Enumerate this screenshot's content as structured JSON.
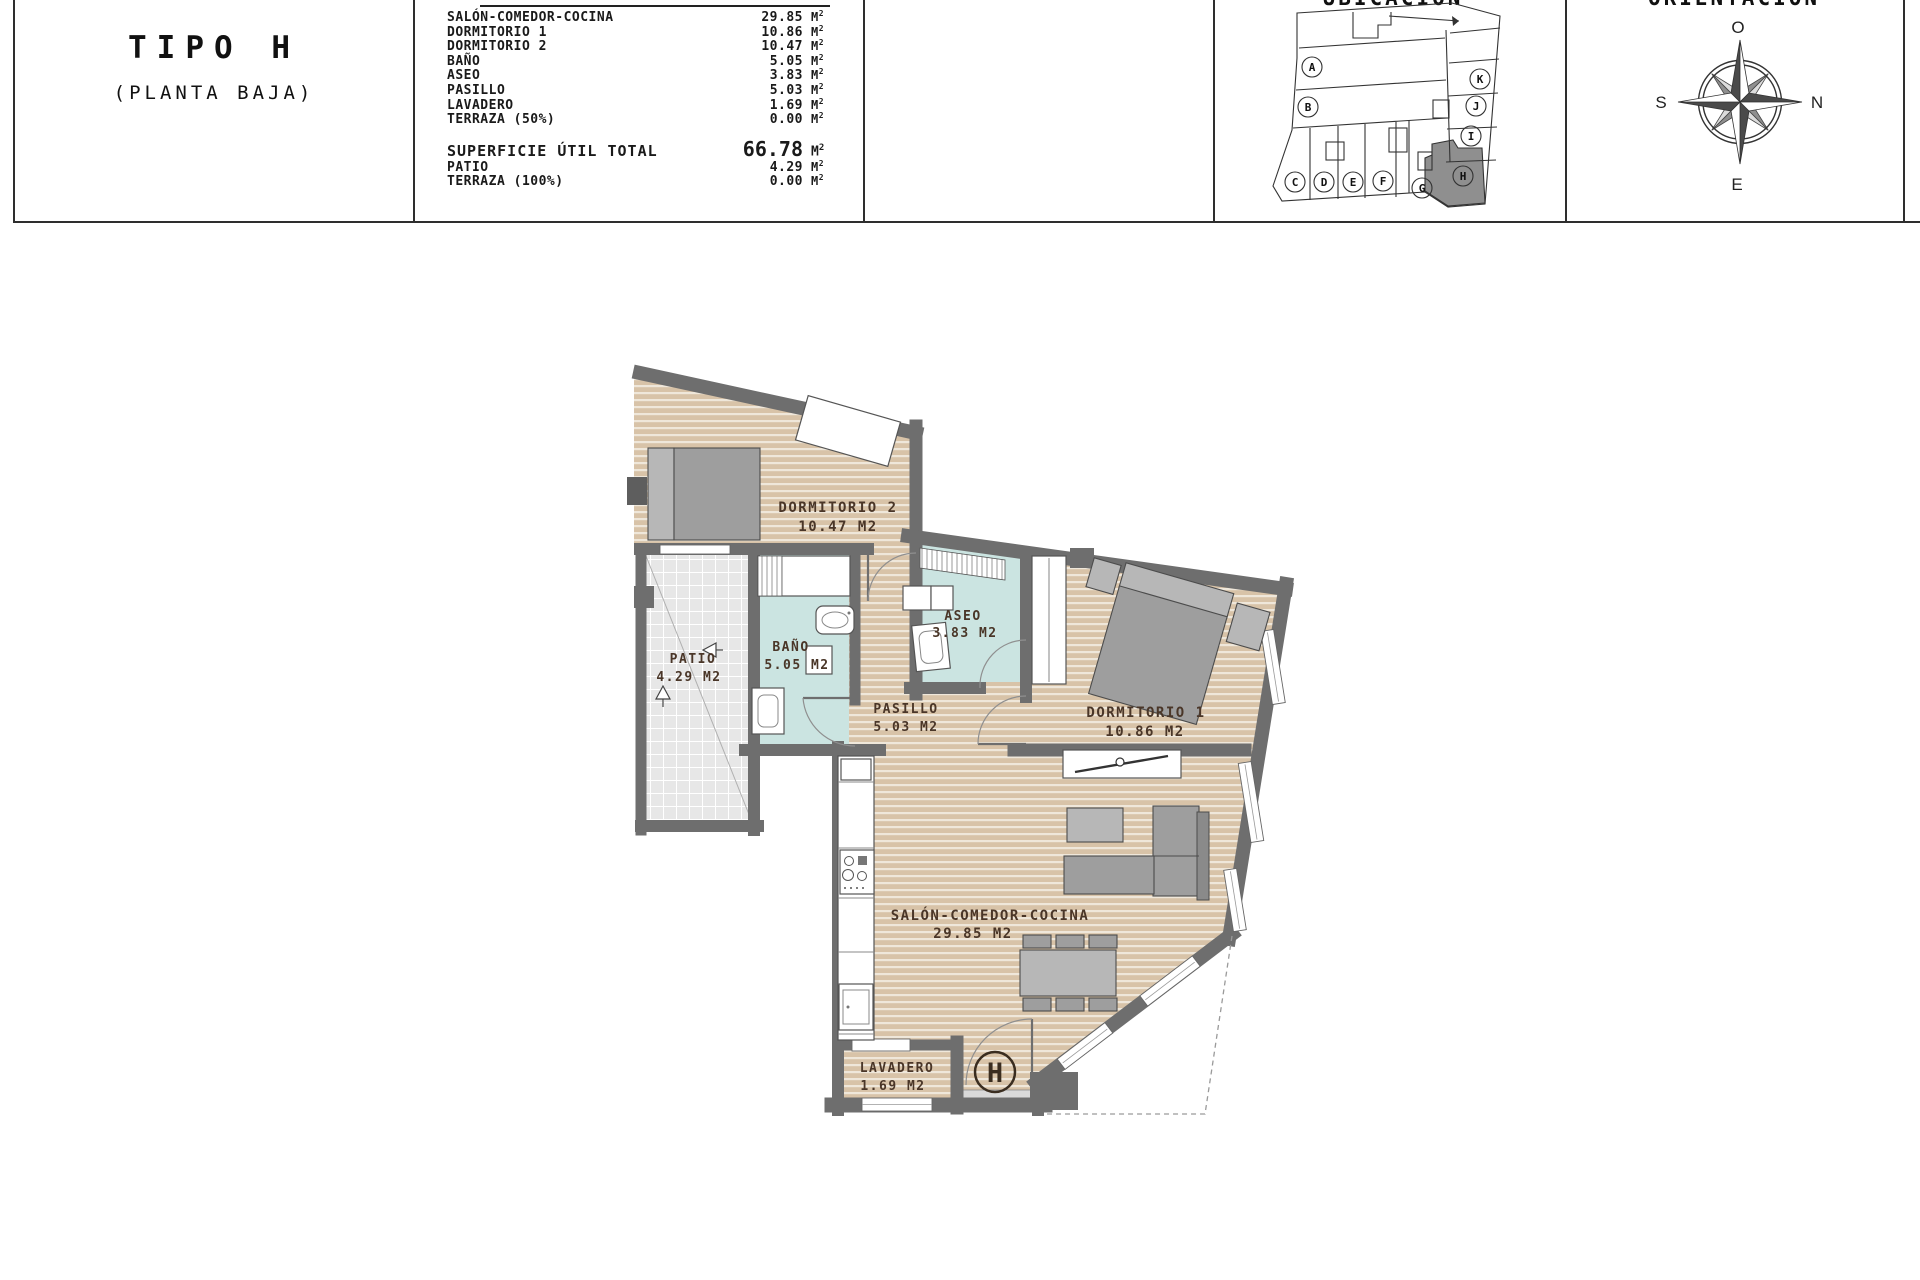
{
  "header": {
    "type_title": "TIPO H",
    "type_subtitle": "(PLANTA BAJA)",
    "table_rows": [
      {
        "label": "SALÓN-COMEDOR-COCINA",
        "value": "29.85"
      },
      {
        "label": "DORMITORIO 1",
        "value": "10.86"
      },
      {
        "label": "DORMITORIO 2",
        "value": "10.47"
      },
      {
        "label": "BAÑO",
        "value": "5.05"
      },
      {
        "label": "ASEO",
        "value": "3.83"
      },
      {
        "label": "PASILLO",
        "value": "5.03"
      },
      {
        "label": "LAVADERO",
        "value": "1.69"
      },
      {
        "label": "TERRAZA (50%)",
        "value": "0.00"
      }
    ],
    "total_row": {
      "label": "SUPERFICIE ÚTIL TOTAL",
      "value": "66.78"
    },
    "extra_rows": [
      {
        "label": "PATIO",
        "value": "4.29"
      },
      {
        "label": "TERRAZA (100%)",
        "value": "0.00"
      }
    ],
    "unit_letter": "M",
    "unit_exponent": "2",
    "ubicacion_title": "UBICACIÓN",
    "orientacion_title": "ORIENTACIÓN"
  },
  "ubicacion_units": [
    "A",
    "B",
    "C",
    "D",
    "E",
    "F",
    "G",
    "H",
    "I",
    "J",
    "K"
  ],
  "highlighted_unit": "H",
  "compass": {
    "top": "O",
    "right": "N",
    "bottom": "E",
    "left": "S"
  },
  "plan": {
    "rooms": {
      "dormitorio2": {
        "name": "DORMITORIO 2",
        "area": "10.47 M2"
      },
      "bano": {
        "name": "BAÑO",
        "area": "5.05 M2"
      },
      "aseo": {
        "name": "ASEO",
        "area": "3.83 M2"
      },
      "patio": {
        "name": "PATIO",
        "area": "4.29 M2"
      },
      "pasillo": {
        "name": "PASILLO",
        "area": "5.03 M2"
      },
      "dormitorio1": {
        "name": "DORMITORIO 1",
        "area": "10.86 M2"
      },
      "salon": {
        "name": "SALÓN-COMEDOR-COCINA",
        "area": "29.85 M2"
      },
      "lavadero": {
        "name": "LAVADERO",
        "area": "1.69 M2"
      }
    },
    "entrance_marker": "H"
  },
  "colors": {
    "wall": "#6e6e6e",
    "wood": "#d8c3a8",
    "wood_stripe": "#efe7da",
    "wet_room": "#cbe4e1",
    "patio_tile": "#e7e7e7",
    "label": "#4a3628",
    "highlight_unit_fill": "#8f8f8f"
  }
}
